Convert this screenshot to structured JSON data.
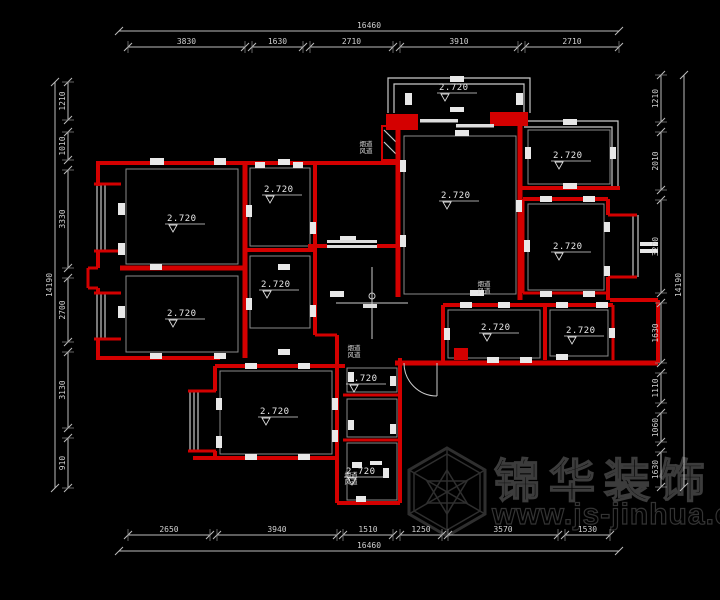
{
  "dimensions": {
    "top": {
      "total": {
        "label": "16460",
        "x": 369,
        "y": 28,
        "line": {
          "y": 31,
          "from": 119,
          "to": 619
        }
      },
      "line_y": 47,
      "segments": [
        {
          "label": "3830",
          "from": 128,
          "to": 245
        },
        {
          "label": "1630",
          "from": 252,
          "to": 303
        },
        {
          "label": "2710",
          "from": 310,
          "to": 393
        },
        {
          "label": "3910",
          "from": 400,
          "to": 518
        },
        {
          "label": "2710",
          "from": 525,
          "to": 619
        }
      ]
    },
    "bottom": {
      "total": {
        "label": "16460",
        "x": 369,
        "y": 548,
        "line": {
          "y": 551,
          "from": 119,
          "to": 619
        }
      },
      "line_y": 535,
      "segments": [
        {
          "label": "2650",
          "from": 128,
          "to": 210
        },
        {
          "label": "3940",
          "from": 217,
          "to": 337
        },
        {
          "label": "1510",
          "from": 343,
          "to": 393
        },
        {
          "label": "1250",
          "from": 400,
          "to": 442
        },
        {
          "label": "3570",
          "from": 448,
          "to": 558
        },
        {
          "label": "1530",
          "from": 565,
          "to": 610
        }
      ]
    },
    "left": {
      "total": {
        "label": "14190",
        "x": 52,
        "y": 285,
        "line": {
          "x": 55,
          "from": 82,
          "to": 488
        }
      },
      "line_x": 68,
      "segments": [
        {
          "label": "1210",
          "from": 82,
          "to": 120
        },
        {
          "label": "1010",
          "from": 132,
          "to": 160
        },
        {
          "label": "3330",
          "from": 170,
          "to": 268
        },
        {
          "label": "2700",
          "from": 278,
          "to": 342
        },
        {
          "label": "3130",
          "from": 352,
          "to": 428
        },
        {
          "label": "910",
          "from": 438,
          "to": 488
        }
      ]
    },
    "right": {
      "total": {
        "label": "14190",
        "x": 681,
        "y": 285,
        "line": {
          "x": 684,
          "from": 75,
          "to": 487
        }
      },
      "line_x": 661,
      "segments": [
        {
          "label": "1210",
          "from": 75,
          "to": 122
        },
        {
          "label": "2010",
          "from": 132,
          "to": 190
        },
        {
          "label": "3270",
          "from": 200,
          "to": 293
        },
        {
          "label": "1630",
          "from": 303,
          "to": 363
        },
        {
          "label": "1110",
          "from": 373,
          "to": 403
        },
        {
          "label": "1060",
          "from": 413,
          "to": 442
        },
        {
          "label": "1630",
          "from": 452,
          "to": 487
        }
      ]
    }
  },
  "elevations": [
    {
      "label": "2.720",
      "x": 456,
      "y": 88
    },
    {
      "label": "2.720",
      "x": 570,
      "y": 156
    },
    {
      "label": "2.720",
      "x": 458,
      "y": 196
    },
    {
      "label": "2.720",
      "x": 184,
      "y": 219
    },
    {
      "label": "2.720",
      "x": 281,
      "y": 190
    },
    {
      "label": "2.720",
      "x": 570,
      "y": 247
    },
    {
      "label": "2.720",
      "x": 278,
      "y": 285
    },
    {
      "label": "2.720",
      "x": 184,
      "y": 314
    },
    {
      "label": "2.720",
      "x": 498,
      "y": 328
    },
    {
      "label": "2.720",
      "x": 583,
      "y": 331
    },
    {
      "label": "2.720",
      "x": 277,
      "y": 412
    },
    {
      "label": "2.720",
      "x": 365,
      "y": 379
    },
    {
      "label": "2.720",
      "x": 363,
      "y": 472
    }
  ],
  "shafts": [
    {
      "line1": "烟道",
      "line2": "风道",
      "x": 366,
      "y": 146
    },
    {
      "line1": "烟道",
      "line2": "风道",
      "x": 484,
      "y": 286
    },
    {
      "line1": "烟道",
      "line2": "风道",
      "x": 354,
      "y": 350
    },
    {
      "line1": "烟道",
      "line2": "风道",
      "x": 351,
      "y": 477
    }
  ],
  "watermark": {
    "brand": "锦华装饰",
    "url": "www.js-jinhua.com"
  }
}
